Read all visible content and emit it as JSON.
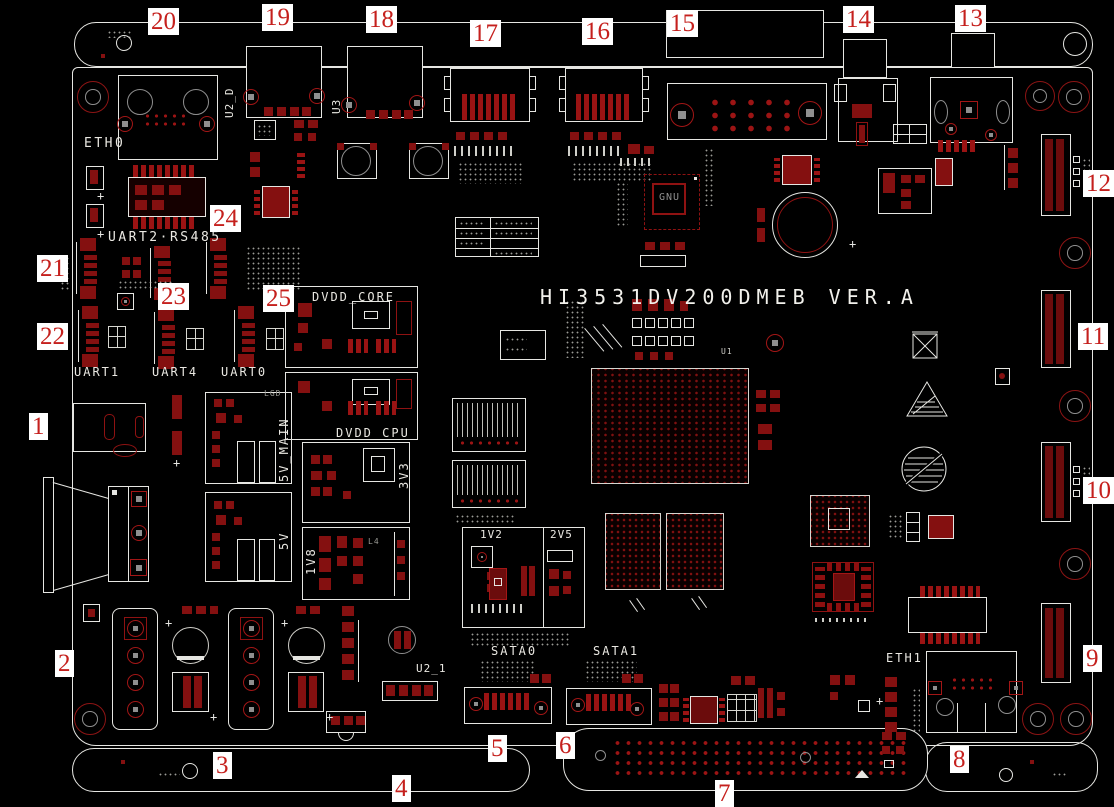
{
  "board": {
    "title": "HI3531DV200DMEB VER.A"
  },
  "callouts": [
    "1",
    "2",
    "3",
    "4",
    "5",
    "6",
    "7",
    "8",
    "9",
    "10",
    "11",
    "12",
    "13",
    "14",
    "15",
    "16",
    "17",
    "18",
    "19",
    "20",
    "21",
    "22",
    "23",
    "24",
    "25"
  ],
  "silkscreen": {
    "eth0": "ETH0",
    "eth1": "ETH1",
    "uart2_rs485": "UART2·RS485",
    "uart1": "UART1",
    "uart4": "UART4",
    "uart0": "UART0",
    "dvdd_core": "DVDD_CORE",
    "dvdd_cpu": "DVDD_CPU",
    "rail_5v_main": "5V_MAIN",
    "rail_5v": "5V",
    "rail_3v3": "3V3",
    "rail_1v8": "1V8",
    "rail_1v2": "1V2",
    "rail_2v5": "2V5",
    "sata0": "SATA0",
    "sata1": "SATA1",
    "ref_u2_d": "U2_D",
    "ref_u3": "U3",
    "ref_u2_1": "U2_1",
    "ref_u1": "U1",
    "ref_lgd": "LGD",
    "ref_l4": "L4",
    "chip_gnu": "GNU",
    "plus": "+"
  },
  "colors": {
    "background": "#000000",
    "board_outline": "#e6e6e2",
    "copper": "#8f1212",
    "callout_red": "#c5201d",
    "silkscreen": "#eae8e2",
    "pad_gray": "#8f8f8f"
  }
}
